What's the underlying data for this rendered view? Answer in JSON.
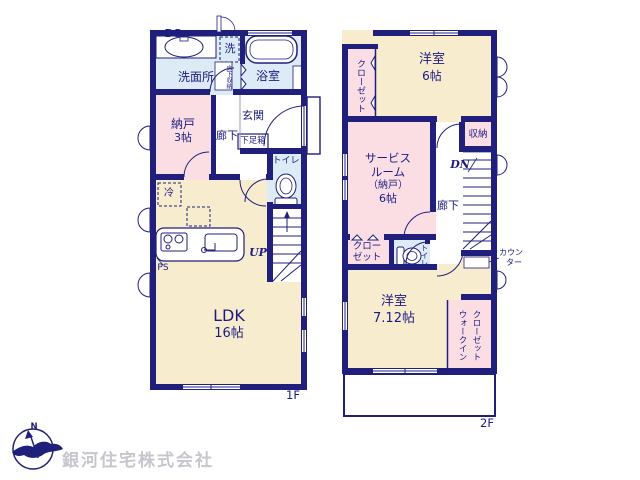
{
  "colors": {
    "wall": "#20207c",
    "text": "#1c1c80",
    "room_cream": "#f7ecce",
    "room_pink": "#fadee4",
    "room_blue": "#dcebf5",
    "company_text": "#c6c6ce"
  },
  "f1": {
    "label": "1F",
    "ds": "DS",
    "washer": "洗",
    "senmenjo": "洗面所",
    "yukashita": "床下収納",
    "yokushitsu": "浴室",
    "nando_name": "納戸",
    "nando_size": "3帖",
    "rouka": "廊下",
    "genkan": "玄関",
    "getabako": "下足箱",
    "toilet": "トイレ",
    "fridge": "冷",
    "up": "UP",
    "ps": "PS",
    "ldk_name": "LDK",
    "ldk_size": "16帖"
  },
  "f2": {
    "label": "2F",
    "closet": "クローゼット",
    "yoshitsu6_name": "洋室",
    "yoshitsu6_size": "6帖",
    "shunou": "収納",
    "service_l1": "サービス",
    "service_l2": "ルーム",
    "service_l3": "（納戸）",
    "service_l4": "6帖",
    "dn": "DN",
    "rouka": "廊下",
    "closet2_l1": "クロー",
    "closet2_l2": "ゼット",
    "toilet": "トイレ",
    "counter_l1": "カウン",
    "counter_l2": "ター",
    "yoshitsu7_name": "洋室",
    "yoshitsu7_size": "7.12帖",
    "wic_col1": "ウォークイン",
    "wic_col2": "クローゼット"
  },
  "footer": {
    "company": "銀河住宅株式会社",
    "compass_n": "N"
  }
}
